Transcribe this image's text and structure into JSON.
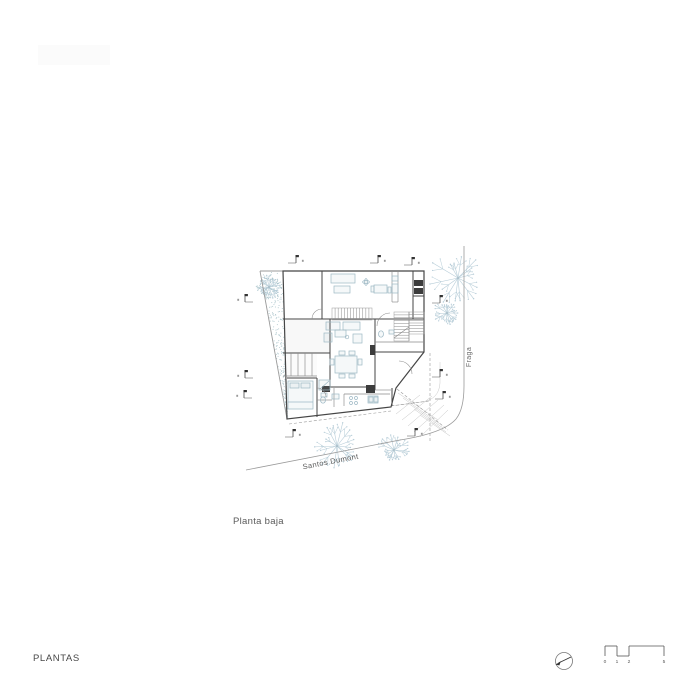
{
  "captions": {
    "plan_caption": "Planta baja",
    "sheet_title": "PLANTAS"
  },
  "streets": [
    {
      "label": "Santos Dumont"
    },
    {
      "label": "Fraga"
    }
  ],
  "scale_bar": {
    "ticks": [
      {
        "label": "0",
        "x": 605
      },
      {
        "label": "1",
        "x": 617
      },
      {
        "label": "2",
        "x": 629
      },
      {
        "label": "5",
        "x": 664
      }
    ],
    "y_top": 646,
    "y_bottom": 656,
    "y_numbers": 663,
    "segments": [
      {
        "x1": 605,
        "x2": 617,
        "level": "top"
      },
      {
        "x1": 617,
        "x2": 629,
        "level": "bottom"
      },
      {
        "x1": 629,
        "x2": 664,
        "level": "top"
      }
    ]
  },
  "north_arrow": {
    "cx": 564,
    "cy": 661,
    "r": 8.5
  },
  "colors": {
    "wall": "#454545",
    "medium": "#8a8a8a",
    "light": "#c9c9c9",
    "plot": "#9a9a9a",
    "street": "#9a9a9a",
    "furniture": "#9db8c4",
    "tree": "#b7cdd8",
    "stipple": "#a9c3ca",
    "dark_fill": "#3c3c3c",
    "hatch": "#c4c4c4",
    "text": "#5a5a5a"
  },
  "plan": {
    "outline": "283,271 424,271 424,352 396,388 391,407 287,419",
    "plot_lines": [
      [
        260,
        271,
        283,
        271
      ],
      [
        260,
        271,
        287,
        419
      ]
    ],
    "walls": [
      [
        283,
        319,
        424,
        319
      ],
      [
        322,
        271,
        322,
        319
      ],
      [
        413,
        271,
        413,
        319
      ],
      [
        413,
        296,
        424,
        296
      ],
      [
        330,
        319,
        330,
        387
      ],
      [
        283,
        353,
        330,
        353
      ],
      [
        287,
        378,
        317,
        378
      ],
      [
        317,
        378,
        317,
        417
      ],
      [
        375,
        319,
        375,
        390
      ],
      [
        330,
        387,
        375,
        387
      ],
      [
        375,
        352,
        424,
        352
      ],
      [
        392,
        388,
        392,
        406
      ]
    ],
    "medium_lines": [
      [
        392,
        272,
        392,
        302
      ],
      [
        398,
        272,
        398,
        302
      ],
      [
        392,
        302,
        398,
        302
      ],
      [
        409,
        312,
        409,
        341
      ],
      [
        375,
        342,
        424,
        342
      ],
      [
        291,
        353,
        291,
        376
      ],
      [
        298,
        353,
        298,
        376
      ],
      [
        305,
        353,
        305,
        376
      ],
      [
        312,
        353,
        312,
        376
      ],
      [
        283,
        376,
        317,
        376
      ],
      [
        344,
        394,
        390,
        394
      ],
      [
        344,
        394,
        344,
        406
      ],
      [
        375,
        390,
        391,
        390
      ],
      [
        317,
        400,
        332,
        400
      ],
      [
        334,
        388,
        334,
        407
      ],
      [
        394,
        338,
        409,
        327
      ]
    ],
    "shade_rects": [
      {
        "x": 284,
        "y": 320,
        "w": 46,
        "h": 33,
        "fill": "#ededed",
        "op": 0.55
      },
      {
        "x": 284,
        "y": 354,
        "w": 33,
        "h": 22,
        "fill": "#f3f3f3",
        "op": 0.5
      }
    ],
    "dark_rects": [
      [
        414,
        280,
        9,
        6
      ],
      [
        414,
        288,
        9,
        6
      ],
      [
        370,
        345,
        5,
        10
      ],
      [
        366,
        385,
        9,
        8
      ],
      [
        322,
        386,
        8,
        6
      ]
    ],
    "furniture_rects": [
      [
        331,
        274,
        24,
        9
      ],
      [
        334,
        286,
        16,
        7
      ],
      [
        374,
        285,
        13,
        8
      ],
      [
        371,
        286,
        3,
        6
      ],
      [
        388,
        287,
        3,
        6
      ],
      [
        392,
        276,
        6,
        5
      ],
      [
        392,
        284,
        6,
        9
      ],
      [
        326,
        322,
        14,
        8
      ],
      [
        343,
        322,
        17,
        8
      ],
      [
        324,
        333,
        8,
        9
      ],
      [
        353,
        334,
        9,
        9
      ],
      [
        335,
        330,
        11,
        7
      ],
      [
        335,
        356,
        22,
        17
      ],
      [
        339,
        351,
        6,
        4
      ],
      [
        349,
        351,
        6,
        4
      ],
      [
        339,
        374,
        6,
        4
      ],
      [
        349,
        374,
        6,
        4
      ],
      [
        330,
        359,
        4,
        6
      ],
      [
        358,
        359,
        4,
        6
      ],
      [
        288,
        381,
        25,
        28
      ],
      [
        290,
        383,
        9,
        5
      ],
      [
        301,
        383,
        9,
        5
      ],
      [
        321,
        393,
        6,
        4
      ],
      [
        332,
        394,
        7,
        5
      ],
      [
        319,
        380,
        11,
        10
      ],
      [
        389,
        330,
        5,
        4
      ],
      [
        368,
        396,
        10,
        7
      ],
      [
        369,
        397,
        4,
        5
      ],
      [
        374,
        397,
        4,
        5
      ]
    ],
    "furniture_ellipses": [
      [
        323,
        400,
        2.5,
        3.2
      ],
      [
        381,
        334,
        2.5,
        3.2
      ],
      [
        366,
        282,
        1.6,
        3.4
      ],
      [
        366,
        282,
        3.4,
        1.6
      ]
    ],
    "furniture_circles": [
      [
        351,
        398,
        1.5
      ],
      [
        356,
        398,
        1.5
      ],
      [
        351,
        403,
        1.5
      ],
      [
        356,
        403,
        1.5
      ],
      [
        347,
        337,
        1.8
      ]
    ],
    "furniture_lines": [
      [
        288,
        402,
        313,
        402
      ],
      [
        320,
        389,
        329,
        381
      ]
    ],
    "door_arcs": [
      "M 312,319 A 10 10 0 0 1 322,309",
      "M 377,326 A 13 13 0 0 1 390,313",
      "M 317,388 A 9 9 0 0 1 326,397",
      "M 399,361 A 13 13 0 0 1 412,374"
    ],
    "stairs": [
      {
        "x": 332,
        "y": 308,
        "w": 40,
        "h": 12,
        "dir": "v",
        "n": 13
      },
      {
        "x": 394,
        "y": 312,
        "w": 15,
        "h": 29,
        "dir": "h",
        "n": 10
      },
      {
        "x": 409,
        "y": 312,
        "w": 15,
        "h": 22,
        "dir": "h",
        "n": 8
      }
    ],
    "dashed_lines": [
      [
        430,
        353,
        430,
        443
      ],
      [
        397,
        389,
        448,
        430
      ],
      [
        289,
        424,
        391,
        411
      ],
      [
        391,
        406,
        429,
        401
      ]
    ],
    "hatch_lines": [
      [
        398,
        393,
        438,
        420
      ],
      [
        403,
        398,
        440,
        424
      ],
      [
        408,
        403,
        443,
        428
      ],
      [
        414,
        409,
        446,
        432
      ],
      [
        420,
        415,
        450,
        436
      ],
      [
        402,
        420,
        432,
        396
      ],
      [
        408,
        426,
        438,
        400
      ],
      [
        414,
        432,
        444,
        405
      ],
      [
        420,
        437,
        448,
        410
      ],
      [
        396,
        414,
        420,
        395
      ]
    ],
    "street_paths": [
      {
        "d": "M 246,470 L 400,440 Q 444,433 456,419 Q 464,409 464,386 L 464,246",
        "col": "street",
        "w": 0.8
      },
      {
        "d": "M 391,406 L 421,402 Q 439,400 440,383 L 440,362",
        "col": "light",
        "w": 0.5
      }
    ],
    "garden": {
      "poly": [
        [
          261,
          272
        ],
        [
          283,
          272
        ],
        [
          283,
          390
        ],
        [
          287,
          418
        ]
      ],
      "dot_count": 230,
      "cluster": {
        "cx": 269,
        "cy": 287,
        "r": 13,
        "count": 90
      }
    },
    "trees": [
      [
        458,
        278,
        30,
        7
      ],
      [
        447,
        313,
        14,
        11
      ],
      [
        337,
        446,
        26,
        3
      ],
      [
        394,
        450,
        17,
        5
      ],
      [
        269,
        287,
        12,
        9
      ]
    ],
    "markers": [
      [
        296,
        263,
        -1
      ],
      [
        378,
        263,
        -1
      ],
      [
        412,
        265,
        -1
      ],
      [
        245,
        302,
        1
      ],
      [
        245,
        378,
        1
      ],
      [
        244,
        398,
        1
      ],
      [
        440,
        303,
        -1
      ],
      [
        440,
        377,
        -1
      ],
      [
        443,
        399,
        -1
      ],
      [
        293,
        437,
        -1
      ],
      [
        415,
        436,
        -1
      ]
    ]
  }
}
